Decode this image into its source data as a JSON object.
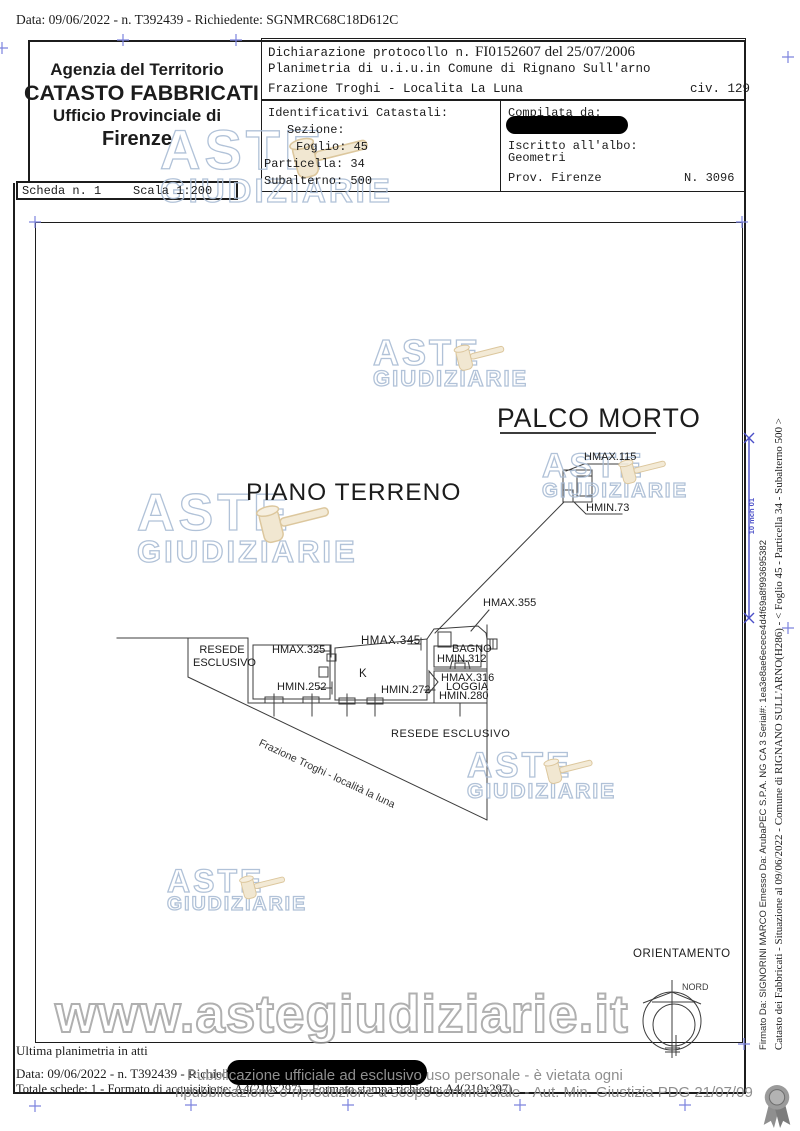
{
  "document": {
    "request_line": "Data: 09/06/2022 - n. T392439 - Richiedente: SGNMRC68C18D612C",
    "agency": {
      "line1": "Agenzia del Territorio",
      "line2": "CATASTO FABBRICATI",
      "line3": "Ufficio Provinciale di",
      "line4": "Firenze"
    },
    "scheda": {
      "number": "Scheda n. 1",
      "scale": "Scala 1:200"
    },
    "declaration": {
      "protocol_label": "Dichiarazione protocollo n.",
      "protocol_value": "FI0152607 del 25/07/2006",
      "line2": "Planimetria di u.i.u.in Comune di Rignano Sull'arno",
      "line3": "Frazione Troghi - Localita La Luna",
      "civ": "civ. 129"
    },
    "cadastral": {
      "title": "Identificativi Catastali:",
      "sezione": "Sezione:",
      "foglio": "Foglio: 45",
      "particella": "Particella: 34",
      "subalterno": "Subalterno: 500"
    },
    "compiler": {
      "label": "Compilata da:",
      "albo1": "Iscritto all'albo:",
      "albo2": "Geometri",
      "prov": "Prov. Firenze",
      "number": "N. 3096"
    }
  },
  "plan": {
    "titles": {
      "palco_morto": "PALCO MORTO",
      "piano_terreno": "PIANO TERRENO"
    },
    "labels": {
      "hmax115": "HMAX.115",
      "hmin73": "HMIN.73",
      "hmax355": "HMAX.355",
      "hmax325": "HMAX.325",
      "hmin252": "HMIN.252",
      "hmax345": "HMAX.345",
      "k": "K",
      "hmin272": "HMIN.272",
      "bagno": "BAGNO",
      "hmin312": "HMIN.312",
      "hmax316": "HMAX.316",
      "loggia": "LOGGIA",
      "hmin280": "HMIN.280",
      "resede_left_1": "RESEDE",
      "resede_left_2": "ESCLUSIVO",
      "resede_right": "RESEDE ESCLUSIVO",
      "street": "Frazione Troghi - località la luna"
    }
  },
  "orientation": {
    "title": "ORIENTAMENTO",
    "north": "NORD"
  },
  "watermarks": {
    "aste_line1": "ASTE",
    "aste_line2": "GIUDIZIARIE",
    "site_url": "www.astegiudiziarie.it"
  },
  "footer": {
    "ultima": "Ultima planimetria in atti",
    "data_line": "Data: 09/06/2022 - n. T392439 - Richiedente:",
    "totale": "Totale schede: 1 - Formato di acquisizione: A4(210x297)  - Formato stampa richiesto: A4(210x297)",
    "disclaimer1": "Pubblicazione ufficiale ad esclusivo uso personale - è vietata ogni",
    "disclaimer2": "ripubblicazione o riproduzione a scopo commerciale - Aut. Min. Giustizia PDG 21/07/09"
  },
  "sidebar": {
    "line1": "Catasto dei Fabbricati - Situazione al 09/06/2022 - Comune di RIGNANO SULL'ARNO(H286) - < Foglio 45 - Particella 34 - Subalterno 500 >",
    "line2": "Firmato Da: SIGNORINI MARCO Emesso Da: ArubaPEC S.P.A. NG CA 3 Serial#: 1ea3e8ae6ecece4d4f69a8f993695382",
    "mark": "10 mch 01"
  },
  "colors": {
    "registration_blue": "#7d84de",
    "signature_blue": "#4b4fc8",
    "watermark_blue": "#a9bcd4",
    "watermark_gray": "#9d9d9d",
    "line_gray": "#3c3c3c",
    "redaction": "#000000"
  }
}
